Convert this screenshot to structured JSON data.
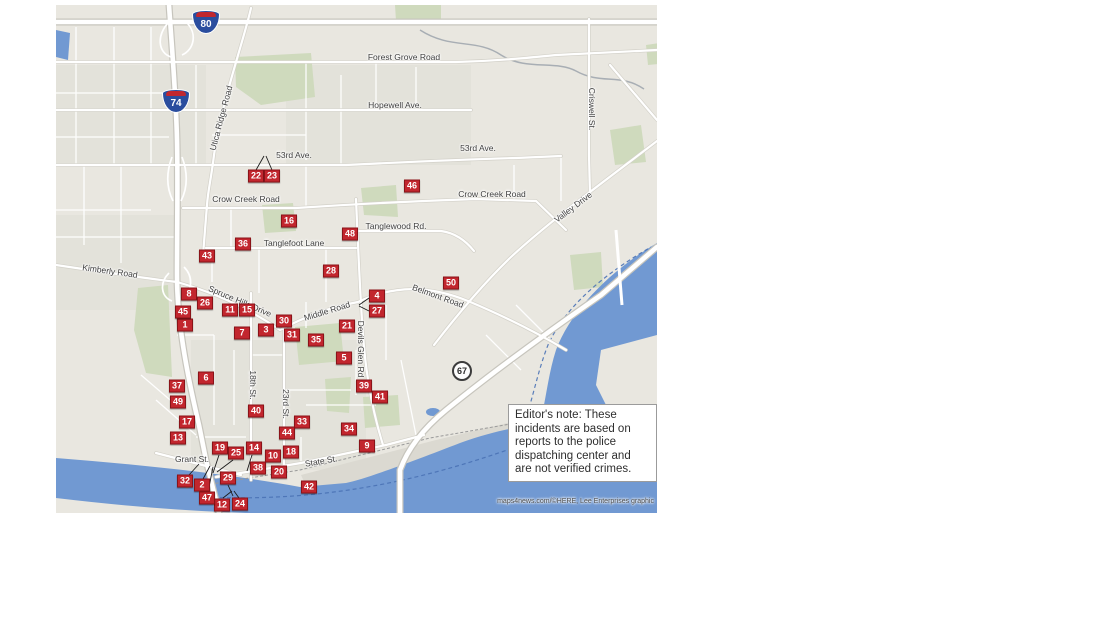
{
  "map": {
    "attribution": "maps4news.com/©HERE, Lee Enterprises graphic",
    "editor_note": "Editor's note: These\nincidents are based on\nreports to the police\ndispatching center and\nare not verified crimes.",
    "colors": {
      "marker": "#c2262e",
      "marker_border": "#8a1318",
      "water": "#7199d2",
      "park": "#cfdabd",
      "land": "#e9e7e0",
      "label": "#3f3f3f"
    },
    "shields": [
      {
        "type": "interstate",
        "num": "80",
        "x": 150,
        "y": 17
      },
      {
        "type": "interstate",
        "num": "74",
        "x": 120,
        "y": 96
      },
      {
        "type": "us",
        "num": "67",
        "x": 406,
        "y": 366
      }
    ],
    "road_labels": [
      {
        "text": "Forest Grove Road",
        "x": 348,
        "y": 52,
        "rot": 0
      },
      {
        "text": "Hopewell Ave.",
        "x": 339,
        "y": 100,
        "rot": 0
      },
      {
        "text": "53rd Ave.",
        "x": 238,
        "y": 150,
        "rot": 0
      },
      {
        "text": "53rd Ave.",
        "x": 422,
        "y": 143,
        "rot": 0
      },
      {
        "text": "Crow Creek Road",
        "x": 190,
        "y": 194,
        "rot": 0
      },
      {
        "text": "Crow Creek Road",
        "x": 436,
        "y": 189,
        "rot": 0
      },
      {
        "text": "Tanglewood Rd.",
        "x": 340,
        "y": 221,
        "rot": 0
      },
      {
        "text": "Tanglefoot Lane",
        "x": 238,
        "y": 238,
        "rot": 0
      },
      {
        "text": "Kimberly Road",
        "x": 54,
        "y": 266,
        "rot": 8
      },
      {
        "text": "Utica Ridge Road",
        "x": 165,
        "y": 113,
        "rot": -75
      },
      {
        "text": "Criswell St.",
        "x": 536,
        "y": 104,
        "rot": 90
      },
      {
        "text": "Valley Drive",
        "x": 517,
        "y": 202,
        "rot": -37
      },
      {
        "text": "Spruce Hills Drive",
        "x": 184,
        "y": 296,
        "rot": 23
      },
      {
        "text": "Middle Road",
        "x": 271,
        "y": 306,
        "rot": -17
      },
      {
        "text": "Belmont Road",
        "x": 382,
        "y": 291,
        "rot": 20
      },
      {
        "text": "Devils Glen Rd",
        "x": 305,
        "y": 344,
        "rot": 90
      },
      {
        "text": "18th St.",
        "x": 197,
        "y": 380,
        "rot": 90
      },
      {
        "text": "23rd St.",
        "x": 230,
        "y": 399,
        "rot": 90
      },
      {
        "text": "Grant St.",
        "x": 136,
        "y": 454,
        "rot": 0
      },
      {
        "text": "State St.",
        "x": 265,
        "y": 456,
        "rot": -10
      }
    ],
    "markers": [
      {
        "n": 1,
        "x": 129,
        "y": 320
      },
      {
        "n": 2,
        "x": 146,
        "y": 480
      },
      {
        "n": 3,
        "x": 210,
        "y": 325
      },
      {
        "n": 4,
        "x": 321,
        "y": 291
      },
      {
        "n": 5,
        "x": 288,
        "y": 353
      },
      {
        "n": 6,
        "x": 150,
        "y": 373
      },
      {
        "n": 7,
        "x": 186,
        "y": 328
      },
      {
        "n": 8,
        "x": 133,
        "y": 289
      },
      {
        "n": 9,
        "x": 311,
        "y": 441
      },
      {
        "n": 10,
        "x": 217,
        "y": 451
      },
      {
        "n": 11,
        "x": 174,
        "y": 305
      },
      {
        "n": 12,
        "x": 166,
        "y": 500
      },
      {
        "n": 13,
        "x": 122,
        "y": 433
      },
      {
        "n": 14,
        "x": 198,
        "y": 443
      },
      {
        "n": 15,
        "x": 191,
        "y": 305
      },
      {
        "n": 16,
        "x": 233,
        "y": 216
      },
      {
        "n": 17,
        "x": 131,
        "y": 417
      },
      {
        "n": 18,
        "x": 235,
        "y": 447
      },
      {
        "n": 19,
        "x": 164,
        "y": 443
      },
      {
        "n": 20,
        "x": 223,
        "y": 467
      },
      {
        "n": 21,
        "x": 291,
        "y": 321
      },
      {
        "n": 22,
        "x": 200,
        "y": 171
      },
      {
        "n": 23,
        "x": 216,
        "y": 171
      },
      {
        "n": 24,
        "x": 184,
        "y": 499
      },
      {
        "n": 25,
        "x": 180,
        "y": 448
      },
      {
        "n": 26,
        "x": 149,
        "y": 298
      },
      {
        "n": 27,
        "x": 321,
        "y": 306
      },
      {
        "n": 28,
        "x": 275,
        "y": 266
      },
      {
        "n": 29,
        "x": 172,
        "y": 473
      },
      {
        "n": 30,
        "x": 228,
        "y": 316
      },
      {
        "n": 31,
        "x": 236,
        "y": 330
      },
      {
        "n": 32,
        "x": 129,
        "y": 476
      },
      {
        "n": 33,
        "x": 246,
        "y": 417
      },
      {
        "n": 34,
        "x": 293,
        "y": 424
      },
      {
        "n": 35,
        "x": 260,
        "y": 335
      },
      {
        "n": 36,
        "x": 187,
        "y": 239
      },
      {
        "n": 37,
        "x": 121,
        "y": 381
      },
      {
        "n": 38,
        "x": 202,
        "y": 463
      },
      {
        "n": 39,
        "x": 308,
        "y": 381
      },
      {
        "n": 40,
        "x": 200,
        "y": 406
      },
      {
        "n": 41,
        "x": 324,
        "y": 392
      },
      {
        "n": 42,
        "x": 253,
        "y": 482
      },
      {
        "n": 43,
        "x": 151,
        "y": 251
      },
      {
        "n": 44,
        "x": 231,
        "y": 428
      },
      {
        "n": 45,
        "x": 127,
        "y": 307
      },
      {
        "n": 46,
        "x": 356,
        "y": 181
      },
      {
        "n": 47,
        "x": 151,
        "y": 493
      },
      {
        "n": 48,
        "x": 294,
        "y": 229
      },
      {
        "n": 49,
        "x": 122,
        "y": 397
      },
      {
        "n": 50,
        "x": 395,
        "y": 278
      }
    ]
  }
}
